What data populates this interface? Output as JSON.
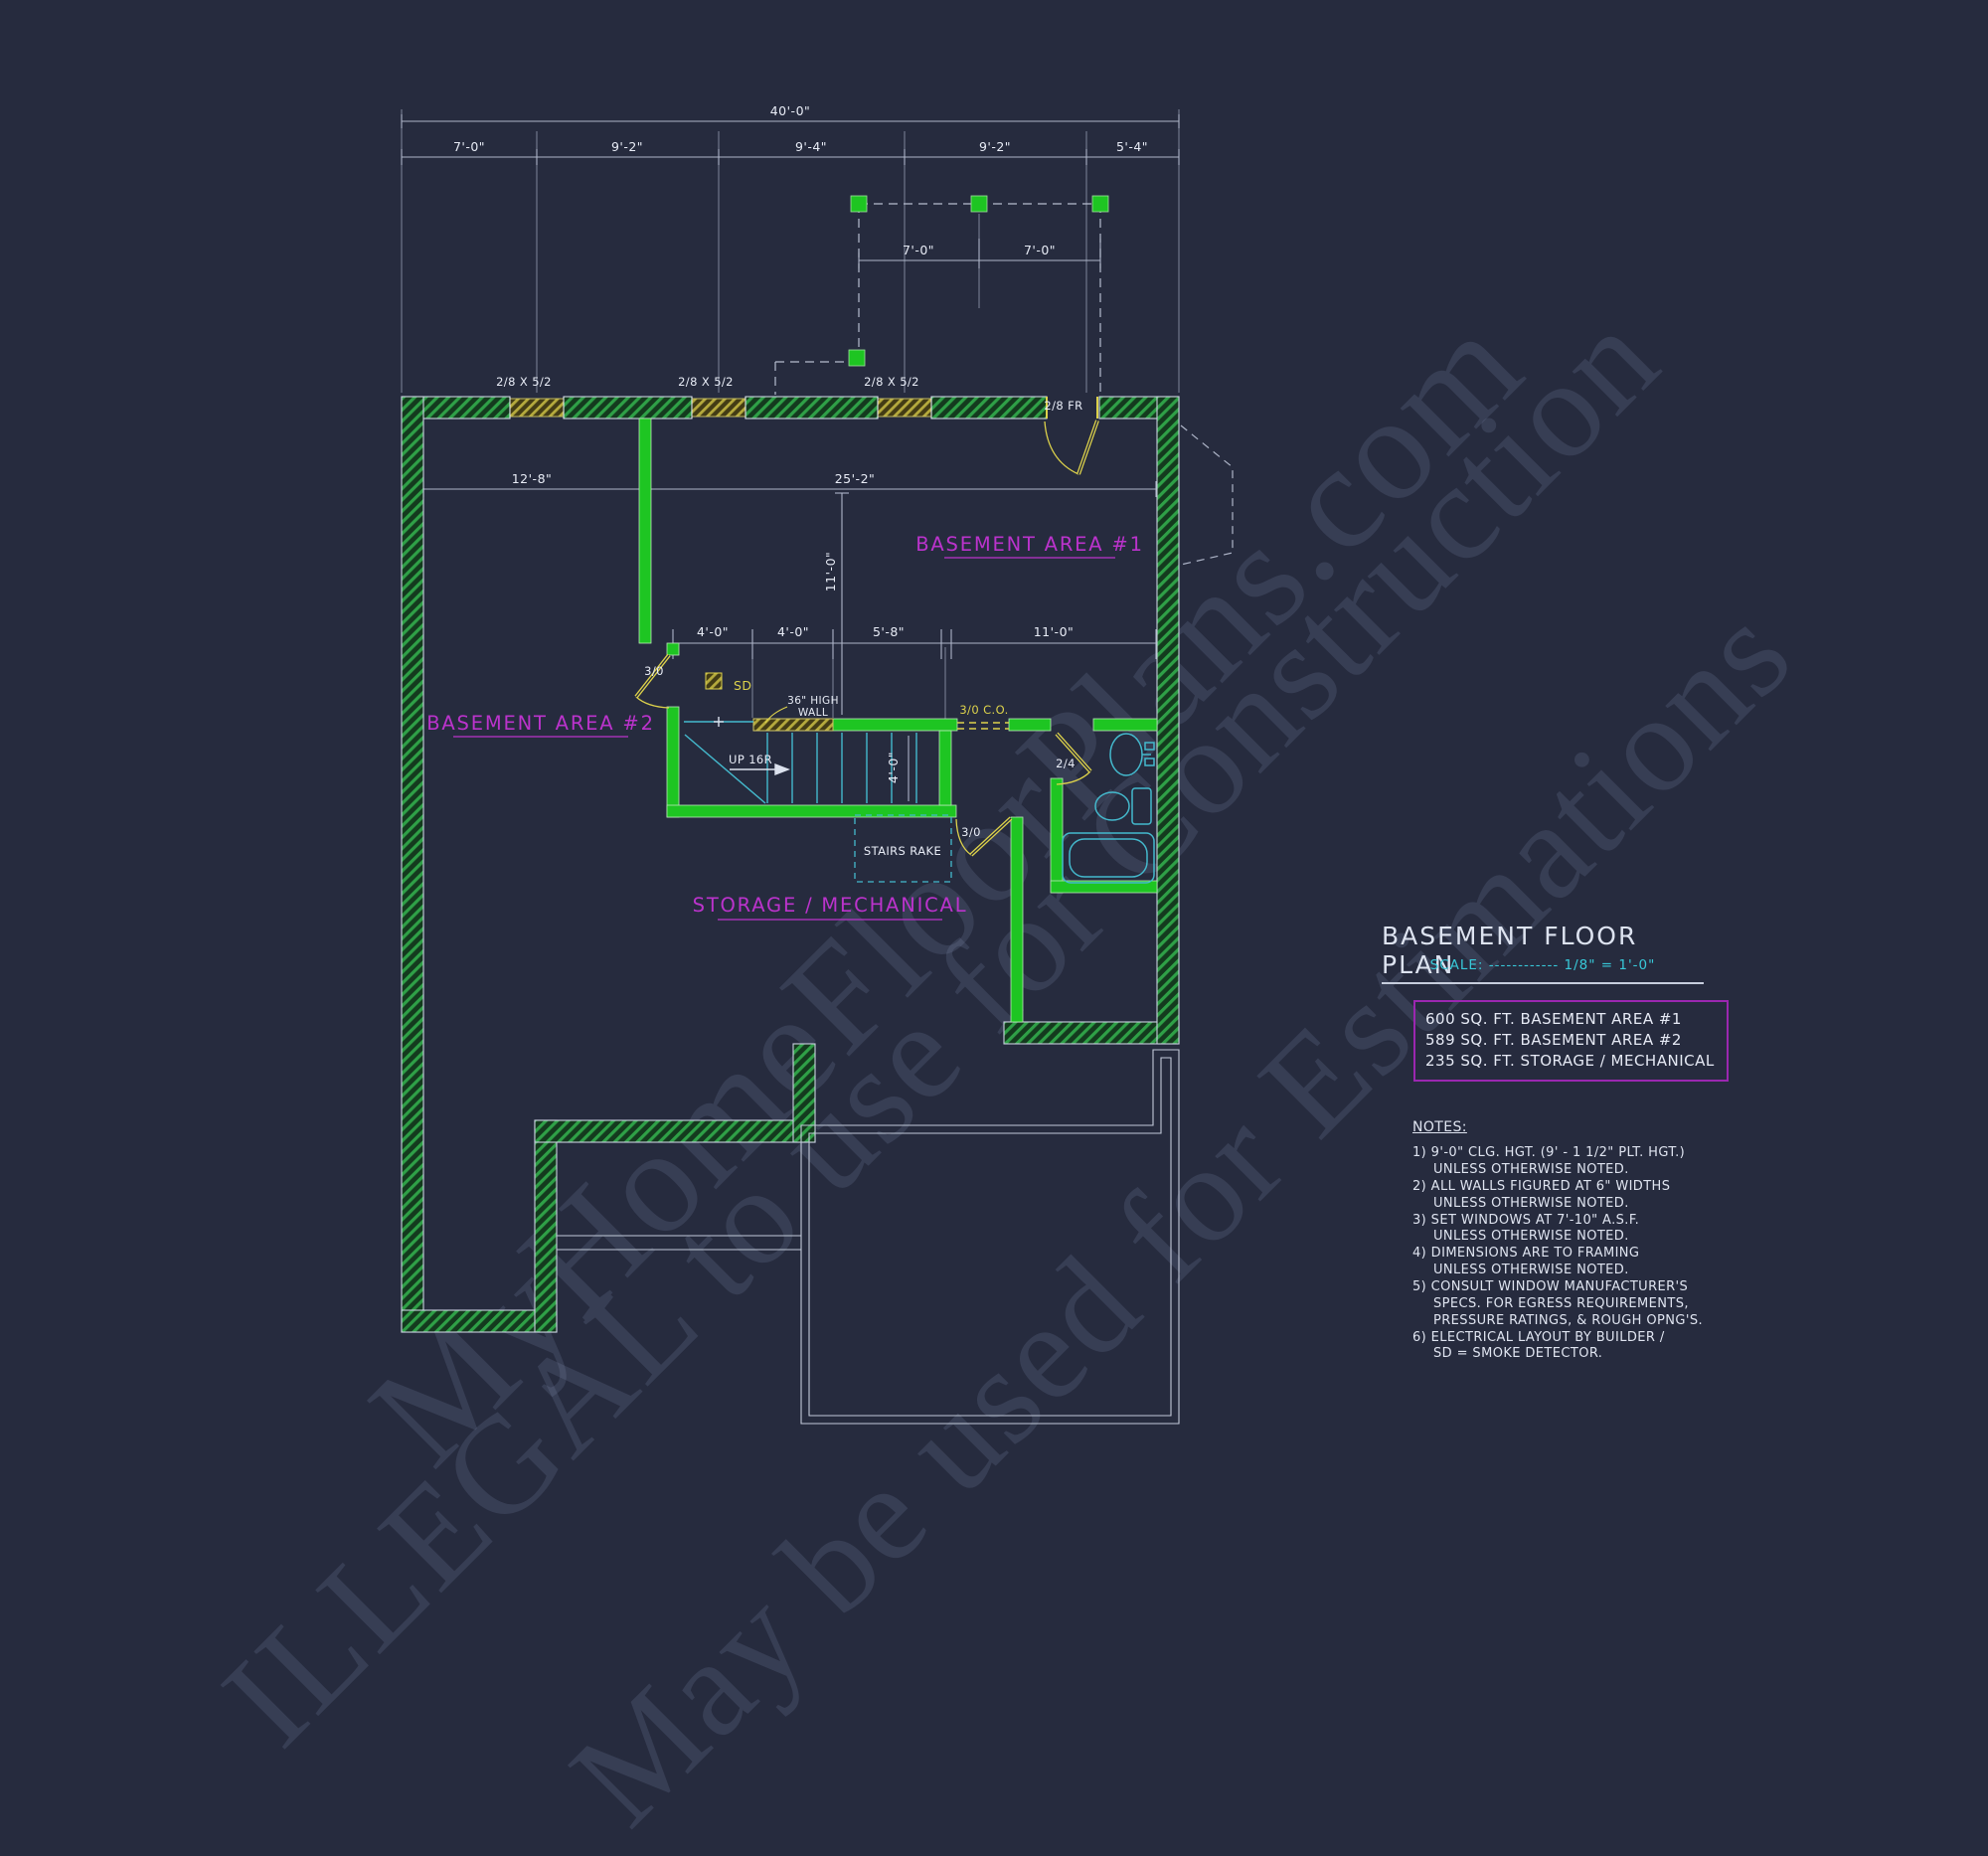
{
  "colors": {
    "background": "#262b3e",
    "wall_green": "#1ec522",
    "hatch_green": "#2fa047",
    "olive": "#b5aa3d",
    "yellow": "#ddd24b",
    "cyan": "#44b9cd",
    "magenta": "#bb33cc",
    "box_purple": "#9b27b0",
    "line_white": "#cdd3e2"
  },
  "watermark": {
    "line1": "MyHomeFloorPlans.com",
    "line2": "ILLEGAL to use for Construction",
    "line3": "May be used for Estimations"
  },
  "plan": {
    "dims": {
      "overall": "40'-0\"",
      "top_segments": [
        "7'-0\"",
        "9'-2\"",
        "9'-4\"",
        "9'-2\"",
        "5'-4\""
      ],
      "porch_segments": [
        "7'-0\"",
        "7'-0\""
      ],
      "ba2_width": "12'-8\"",
      "ba1_width": "25'-2\"",
      "ba1_depth": "11'-0\"",
      "mid_segments": [
        "4'-0\"",
        "4'-0\"",
        "5'-8\"",
        "11'-0\""
      ],
      "stair_width": "4'-0\""
    },
    "labels": {
      "window": "2/8 X 5/2",
      "front_door": "2/8 FR",
      "ba2_door": "3/0",
      "storage_door": "3/0",
      "bath_door": "2/4",
      "cased_opening": "3/0 C.O.",
      "smoke_detector": "SD",
      "up": "UP 16R",
      "half_wall_line1": "36\" HIGH",
      "half_wall_line2": "WALL",
      "stairs_rake": "STAIRS RAKE"
    },
    "rooms": {
      "ba1": "BASEMENT AREA #1",
      "ba2": "BASEMENT AREA #2",
      "storage": "STORAGE / MECHANICAL"
    }
  },
  "titleblock": {
    "title": "BASEMENT FLOOR PLAN",
    "scale_prefix": "SCALE:",
    "scale_dashes": "------------",
    "scale_value": "1/8\" = 1'-0\"",
    "areas": [
      "600 SQ. FT. BASEMENT AREA #1",
      "589 SQ. FT. BASEMENT AREA #2",
      "235 SQ. FT. STORAGE / MECHANICAL"
    ],
    "notes_title": "NOTES:",
    "notes": [
      "1) 9'-0\"  CLG. HGT. (9' - 1 1/2\" PLT. HGT.)",
      "UNLESS OTHERWISE NOTED.",
      "2) ALL  WALLS FIGURED AT 6\" WIDTHS",
      "UNLESS OTHERWISE NOTED.",
      "3) SET WINDOWS AT 7'-10\" A.S.F.",
      "UNLESS OTHERWISE NOTED.",
      "4) DIMENSIONS ARE TO FRAMING",
      "UNLESS OTHERWISE NOTED.",
      "5) CONSULT WINDOW MANUFACTURER'S",
      "SPECS. FOR EGRESS REQUIREMENTS,",
      "PRESSURE RATINGS, & ROUGH OPNG'S.",
      "6) ELECTRICAL LAYOUT BY BUILDER /",
      "SD = SMOKE DETECTOR."
    ]
  }
}
